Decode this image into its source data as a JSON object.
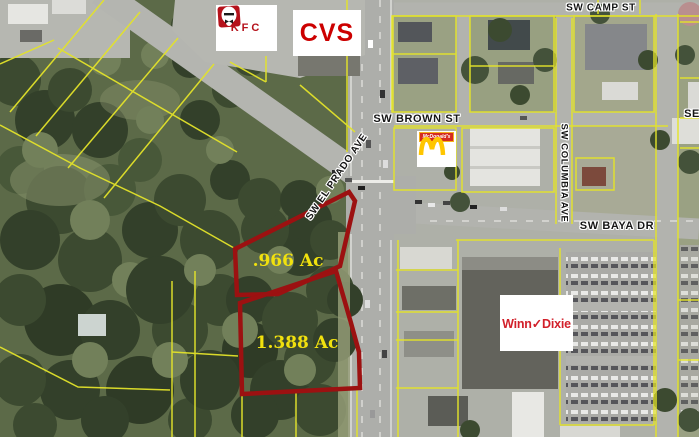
{
  "map_type": "aerial-property-map",
  "streets": [
    {
      "name": "SW CAMP ST",
      "orientation": "horizontal"
    },
    {
      "name": "SW BROWN ST",
      "orientation": "horizontal"
    },
    {
      "name": "SW EL PRADO AVE",
      "orientation": "diagonal"
    },
    {
      "name": "SW COLUMBIA AVE",
      "orientation": "vertical"
    },
    {
      "name": "SW BAYA DR",
      "orientation": "horizontal"
    },
    {
      "name": "SE",
      "orientation": "horizontal"
    }
  ],
  "parcels": [
    {
      "area_label": ".966 Ac",
      "acres": 0.966
    },
    {
      "area_label": "1.388 Ac",
      "acres": 1.388
    }
  ],
  "businesses": [
    {
      "name": "KFC"
    },
    {
      "name": "CVS"
    },
    {
      "name": "McDonald's"
    },
    {
      "name": "Winn✓Dixie"
    }
  ],
  "colors": {
    "parcel_outline_red": "#9c1111",
    "acreage_label_yellow": "#f1e10e",
    "property_line_yellow": "#e3e32a",
    "kfc_red": "#b5121b",
    "cvs_red": "#cc0000",
    "mcdonalds_gold": "#ffc600",
    "mcdonalds_red": "#d52b1e",
    "winn_dixie_red": "#d2202a"
  }
}
